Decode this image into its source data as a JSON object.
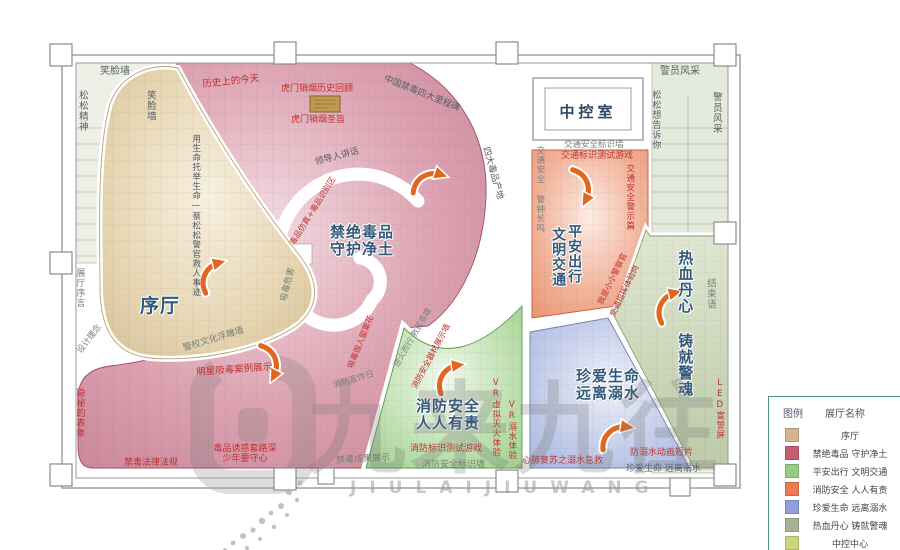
{
  "labels": {
    "smile_top": "笑脸墙",
    "songsong_spirit": "松松精神",
    "smile_side": "笑脸墙",
    "police_top": "警员风采",
    "songsong_tell": "松松想告诉你",
    "police_side": "警员风采",
    "conclusion": "结束语",
    "led_screen": "LED宣誓屏",
    "control_room": "中控室",
    "prologue": "序厅",
    "preface": "展厅序言",
    "design_concept": "设计理念",
    "life_rescue": "用生命托举生命—蔡松松警官救人事迹",
    "relief_wall": "警校文化浮雕墙",
    "history_today": "历史上的今天",
    "humen_review": "虎门销烟历史回顾",
    "humen_edict": "虎门销烟圣旨",
    "milestone": "中国禁毒四大里程碑",
    "drug_origin": "四大毒品产地",
    "leader_speech": "领导人讲话",
    "drug_model": "毒品仿真+毒品识别区",
    "drug_harm": "吸毒危害",
    "drug_ruin": "吸毒毁人罂粟花",
    "pink_title_1": "禁绝毒品",
    "pink_title_2": "守护净土",
    "star_cases": "明星吸毒案例展示",
    "hidden_surface": "隐秘的表象",
    "drug_laws": "禁毒法律法规",
    "temptation_1": "毒品诱惑套路深",
    "temptation_2": "少年要守心",
    "achievements": "禁毒成果展示",
    "fire_day": "消防宣传日",
    "fire_hero": "逆火而行 救民英雄",
    "fire_equipment": "消防安全器材展示墙",
    "fire_title_1": "消防安全",
    "fire_title_2": "人人有责",
    "fire_game": "消防标识测试游戏",
    "fire_wall": "消防安全标识墙",
    "vr_fire": "VR虚拟灭火体验",
    "traffic_wall": "交通安全标识墙",
    "traffic_game": "交通标识测试游戏",
    "traffic_bell": "交通安全 警钟长鸣",
    "traffic_warning": "交通安全警示篇",
    "traffic_title_1": "平安出行",
    "traffic_title_2": "文明交通",
    "little_police_1": "我是小小警察官",
    "little_police_2": "交通指挥体验岗",
    "water_title_1": "珍爱生命",
    "water_title_2": "远离溺水",
    "cpr": "心肺复苏之溺水急救",
    "water_anim": "防溺水动画短片",
    "water_slogan": "珍爱生命 远离溺水",
    "vr_water": "VR溺水体验",
    "blood_title": "热血丹心 铸就警魂"
  },
  "legend": {
    "header_left": "图例",
    "header_right": "展厅名称",
    "rows": [
      {
        "label": "序厅",
        "color": "#d4b48c"
      },
      {
        "label": "禁绝毒品 守护净土",
        "color": "#c4616e"
      },
      {
        "label": "平安出行 文明交通",
        "color": "#95cc7e"
      },
      {
        "label": "消防安全 人人有责",
        "color": "#f07a50"
      },
      {
        "label": "珍爱生命 远离溺水",
        "color": "#8f9fd9"
      },
      {
        "label": "热血丹心 铸就警魂",
        "color": "#a9b393"
      },
      {
        "label": "中控中心",
        "color": "#ccd67e"
      }
    ]
  },
  "watermark": {
    "cn": "九来九往",
    "en": "JIULAIJIUWANG"
  },
  "colors": {
    "zone_prologue": "#e3d3ab",
    "zone_drug": "#d58fa2",
    "zone_fire": "#a6d593",
    "zone_traffic": "#eb9476",
    "zone_water": "#a3b3e0",
    "zone_police": "#c3cfae",
    "label_red": "#c22f2f",
    "arrow_orange": "#e2661f",
    "legend_border": "#4d8f85"
  }
}
